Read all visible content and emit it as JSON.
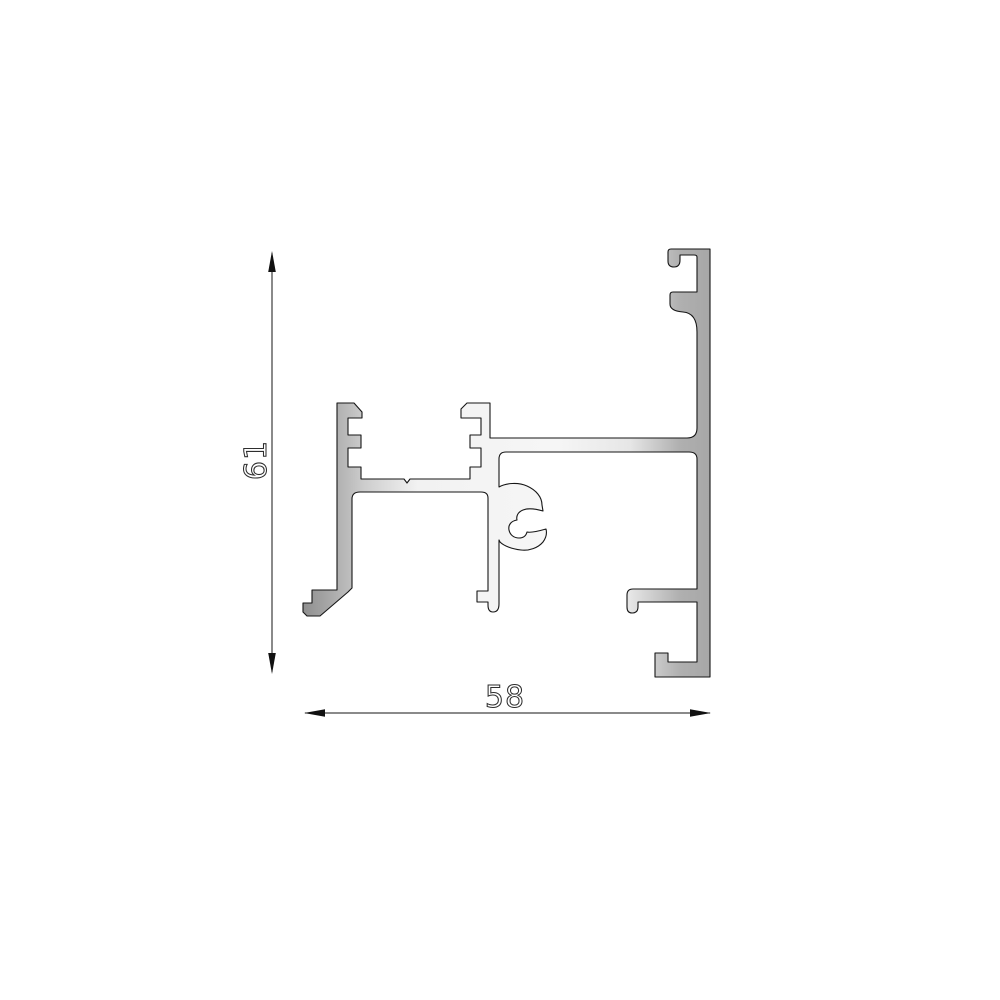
{
  "drawing": {
    "type": "technical-drawing",
    "subject": "aluminium extrusion profile cross-section",
    "dimensions": {
      "height_label": "61",
      "width_label": "58"
    },
    "colors": {
      "background": "#ffffff",
      "outline": "#161616",
      "fill_dark": "#8f8f8f",
      "fill_mid": "#b2b2b2",
      "fill_light": "#f6f6f6",
      "dimension_text": "#2e2e2e"
    }
  }
}
